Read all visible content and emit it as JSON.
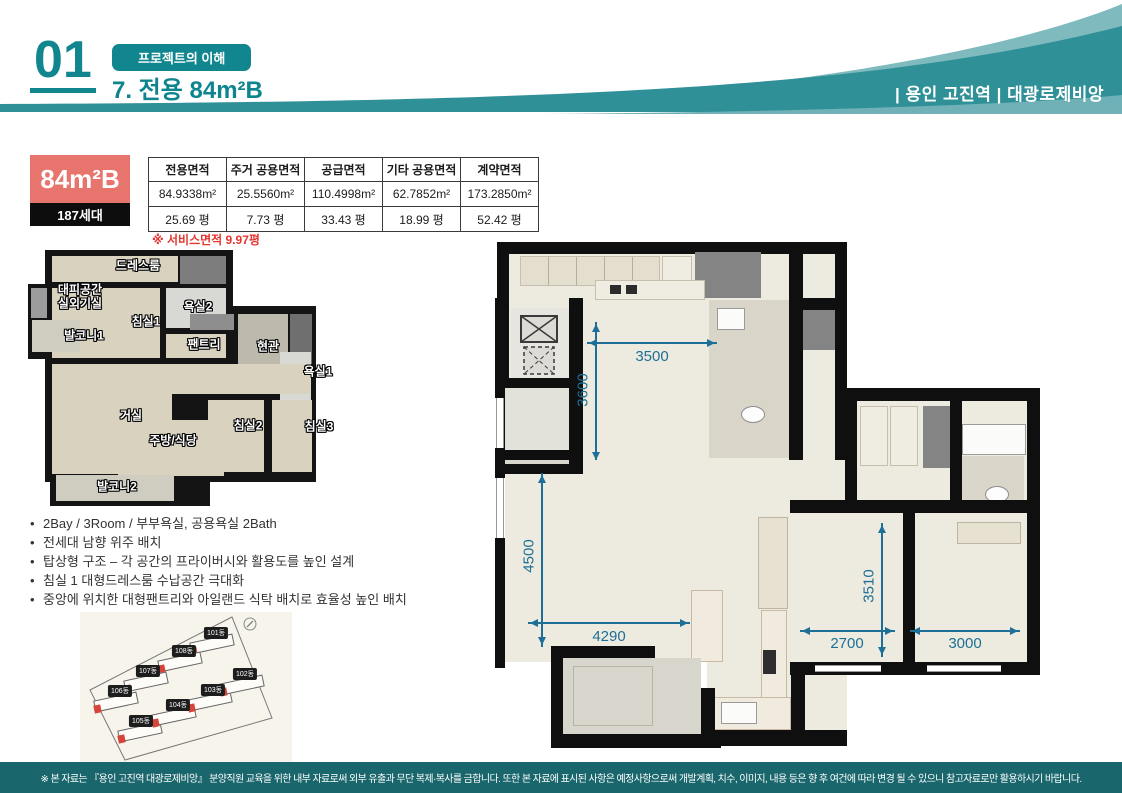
{
  "header": {
    "number": "01",
    "badge": "프로젝트의 이해",
    "title": "7. 전용 84m²B",
    "project": "| 용인 고진역 | 대광로제비앙"
  },
  "unit": {
    "name": "84m²B",
    "households": "187세대",
    "service_note": "※ 서비스면적 9.97평"
  },
  "area_table": {
    "headers": [
      "전용면적",
      "주거 공용면적",
      "공급면적",
      "기타 공용면적",
      "계약면적"
    ],
    "sqm": [
      "84.9338m²",
      "25.5560m²",
      "110.4998m²",
      "62.7852m²",
      "173.2850m²"
    ],
    "pyeong": [
      "25.69 평",
      "7.73 평",
      "33.43 평",
      "18.99 평",
      "52.42 평"
    ]
  },
  "features": [
    "2Bay / 3Room / 부부욕실, 공용욕실 2Bath",
    "전세대 남향 위주 배치",
    "탑상형 구조 – 각 공간의 프라이버시와 활용도를 높인 설계",
    "침실 1 대형드레스룸 수납공간 극대화",
    "중앙에 위치한 대형팬트리와 아일랜드 식탁 배치로 효율성 높인 배치"
  ],
  "plan_small": {
    "rooms": [
      "드레스룸",
      "대피공간",
      "실외기실",
      "침실1",
      "욕실2",
      "발코니1",
      "팬트리",
      "현관",
      "욕실1",
      "거실",
      "주방/식당",
      "침실2",
      "침실3",
      "발코니2"
    ]
  },
  "plan_large": {
    "dims": [
      "3500",
      "3600",
      "4500",
      "4290",
      "3510",
      "2700",
      "3000"
    ]
  },
  "site_map": {
    "buildings": [
      "101동",
      "102동",
      "103동",
      "104동",
      "105동",
      "106동",
      "107동",
      "108동"
    ]
  },
  "footer": {
    "disclaimer": "※ 본 자료는 『용인 고진역 대광로제비앙』 분양직원 교육을 위한 내부 자료로써 외부 유출과 무단 복제·복사를 금합니다. 또한 본 자료에 표시된 사항은 예정사항으로써 개발계획, 치수, 이미지, 내용 등은 향 후 여건에 따라 변경 될 수 있으니 참고자료로만 활용하시기 바랍니다."
  },
  "colors": {
    "teal_main": "#2f9097",
    "teal_light": "#7fbabe",
    "teal_text": "#0e858e",
    "footer_bg": "#19666c",
    "unit_red": "#e8756d",
    "note_red": "#e53530",
    "dim_blue": "#1d6f97"
  }
}
